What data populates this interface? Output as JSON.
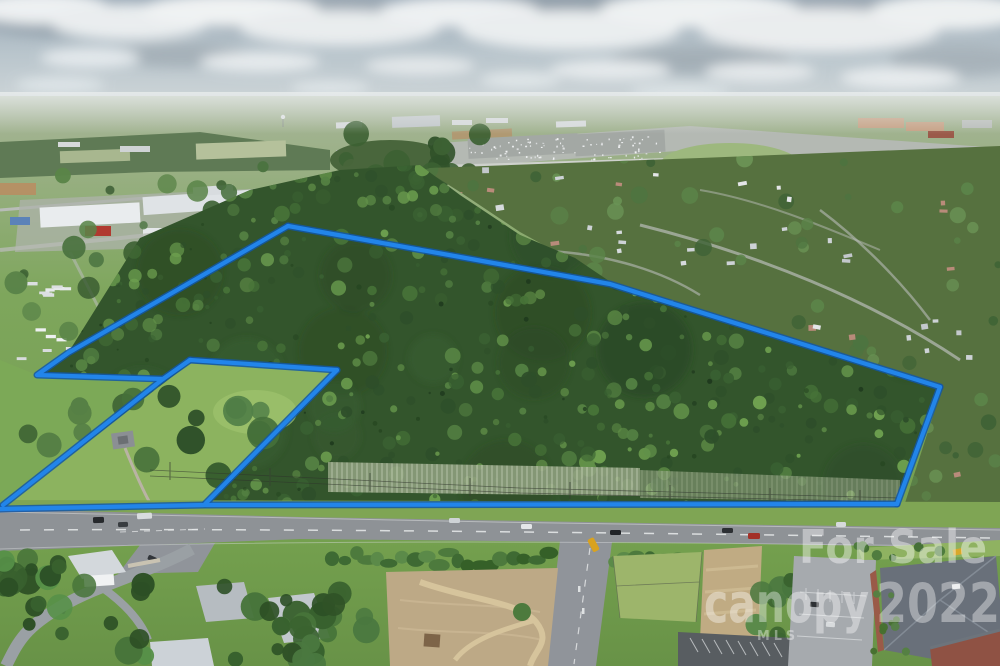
{
  "photo": {
    "kind": "aerial-drone-photo",
    "subject": "wooded-land-parcel-with-blue-for-sale-boundary"
  },
  "watermarks": {
    "for_sale": "For Sale",
    "brand": "canopy",
    "brand_sub": "MLS",
    "year": "2022",
    "color": "#ffffff"
  },
  "boundary": {
    "color": "#2285ea",
    "outline_color": "#1257a8",
    "polylines": [
      {
        "name": "northwest-edge",
        "points": "288,226 68,353 37,375 163,379"
      },
      {
        "name": "southwest-diagonal",
        "points": "190,360 163,379 3,505"
      },
      {
        "name": "notch-top-edge",
        "points": "190,360 337,370"
      },
      {
        "name": "notch-inner-edge",
        "points": "337,370 205,504"
      },
      {
        "name": "road-frontage-edge",
        "points": "0,509 205,505 897,504"
      },
      {
        "name": "northeast-edge",
        "points": "288,226 610,284 940,387"
      },
      {
        "name": "east-edge",
        "points": "940,387 897,504"
      }
    ]
  }
}
